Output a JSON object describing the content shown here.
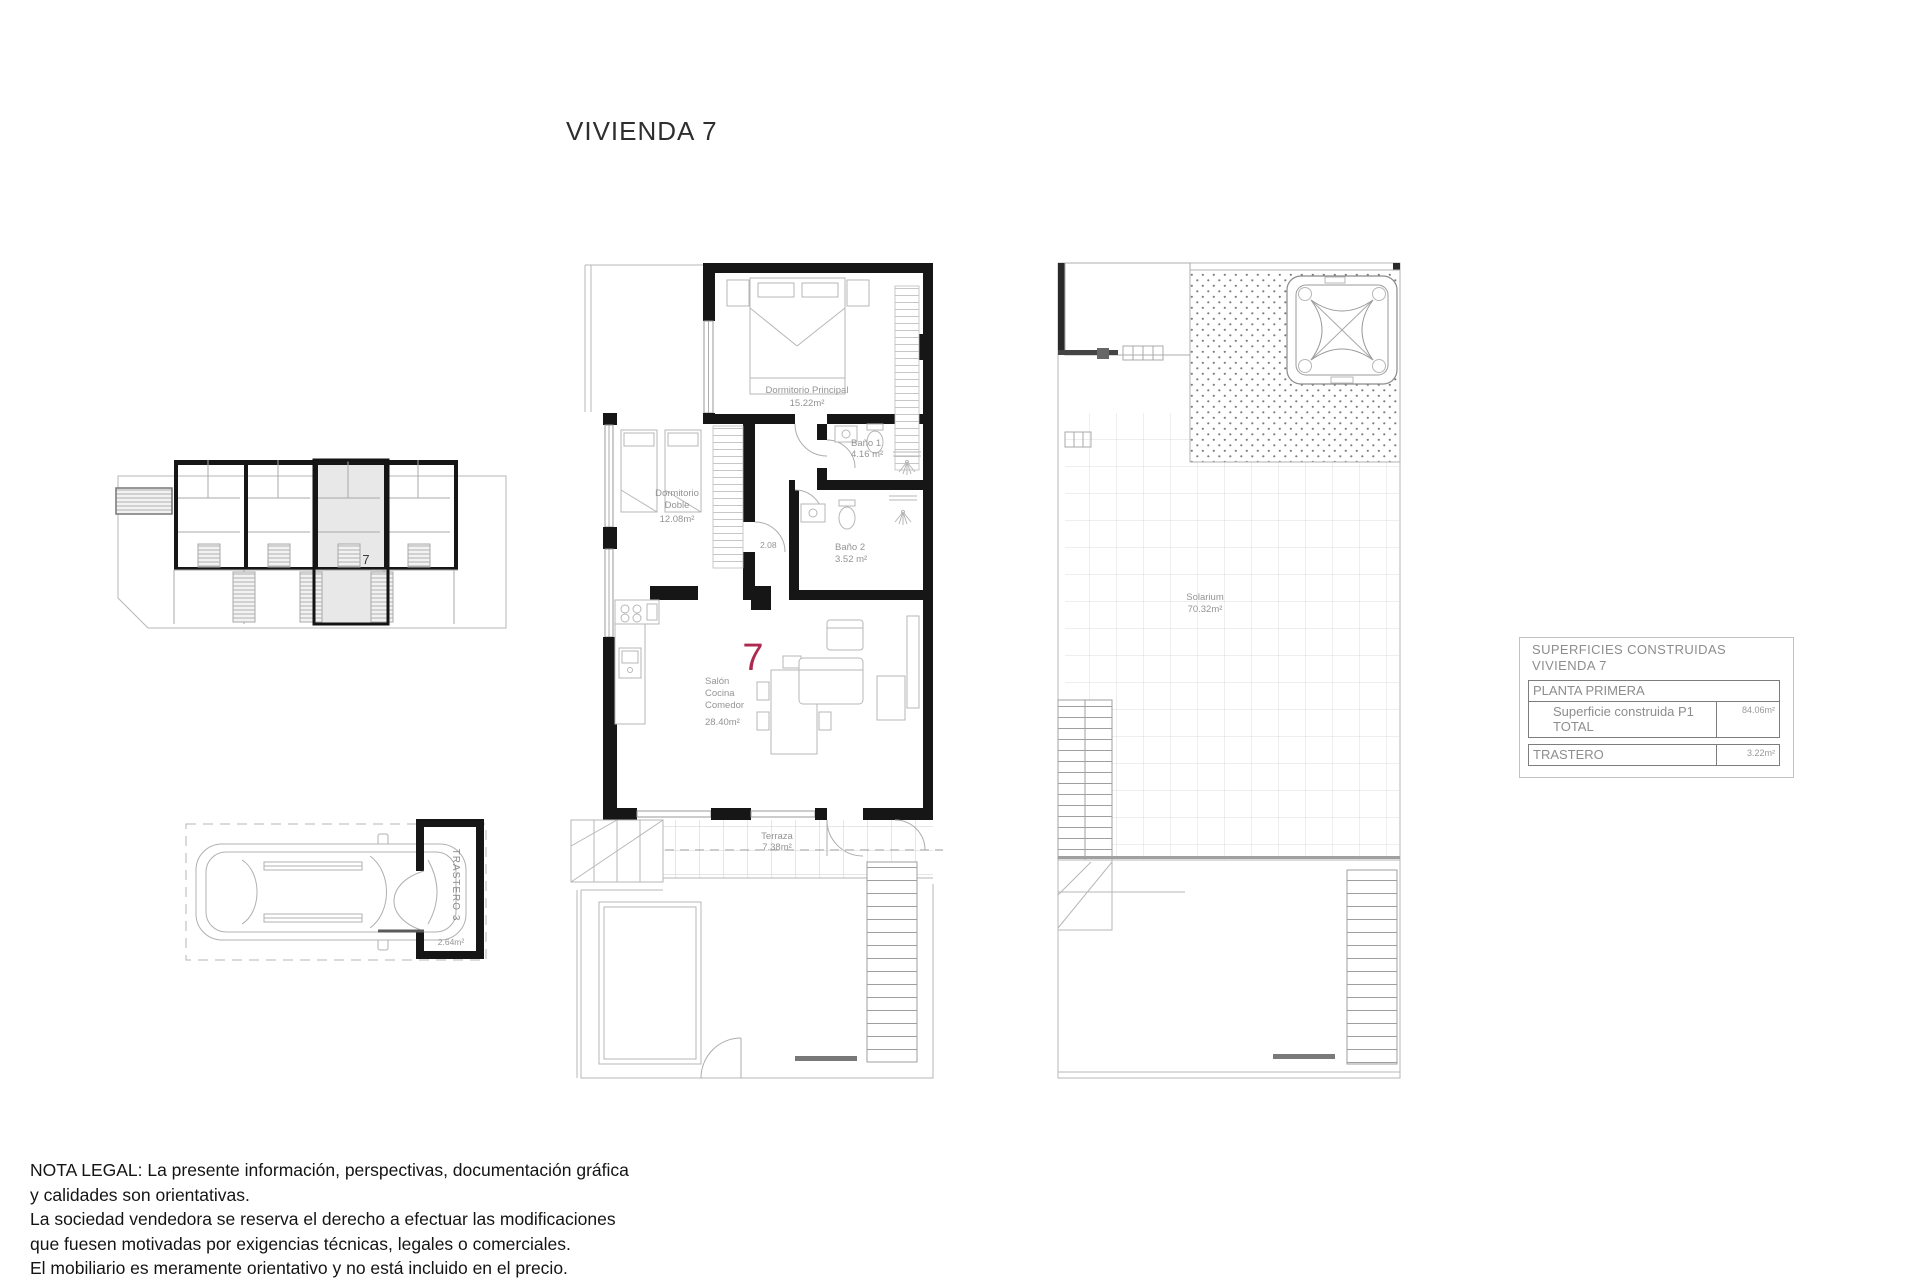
{
  "title": "VIVIENDA 7",
  "colors": {
    "accent_unit_number": "#ad2a4e",
    "wall": "#161616",
    "label_gray": "#949494",
    "key_plan_highlight": "#e8e8e8"
  },
  "key_plan": {
    "unit_number": "7"
  },
  "storage_room": {
    "label": "TRASTERO 3",
    "area": "2.64m²"
  },
  "main_plan": {
    "unit_number": "7",
    "hall_dimension": "2.08",
    "rooms": {
      "dormitorio_principal": {
        "name": "Dormitorio Principal",
        "area": "15.22m²"
      },
      "bano_1": {
        "name": "Baño 1",
        "area": "4.16 m²"
      },
      "dormitorio_doble": {
        "line1": "Dormitorio",
        "line2": "Doble",
        "area": "12.08m²"
      },
      "bano_2": {
        "name": "Baño 2",
        "area": "3.52 m²"
      },
      "salon": {
        "line1": "Salón",
        "line2": "Cocina",
        "line3": "Comedor",
        "area": "28.40m²"
      },
      "terraza": {
        "name": "Terraza",
        "area": "7.38m²"
      }
    }
  },
  "solarium_plan": {
    "room": {
      "name": "Solarium",
      "area": "70.32m²"
    }
  },
  "summary_table": {
    "title_line1": "SUPERFICIES CONSTRUIDAS",
    "title_line2": "VIVIENDA 7",
    "planta_header": "PLANTA PRIMERA",
    "p1_label": "Superficie construida P1 TOTAL",
    "p1_value": "84.06m²",
    "trastero_label": "TRASTERO",
    "trastero_value": "3.22m²"
  },
  "legal_note": {
    "lines": [
      "NOTA LEGAL: La presente información, perspectivas, documentación gráfica",
      "y calidades son orientativas.",
      "La sociedad vendedora se reserva el derecho a efectuar las modificaciones",
      "que fuesen motivadas por exigencias técnicas, legales o comerciales.",
      "El mobiliario es meramente orientativo y no está incluido en el precio."
    ]
  }
}
